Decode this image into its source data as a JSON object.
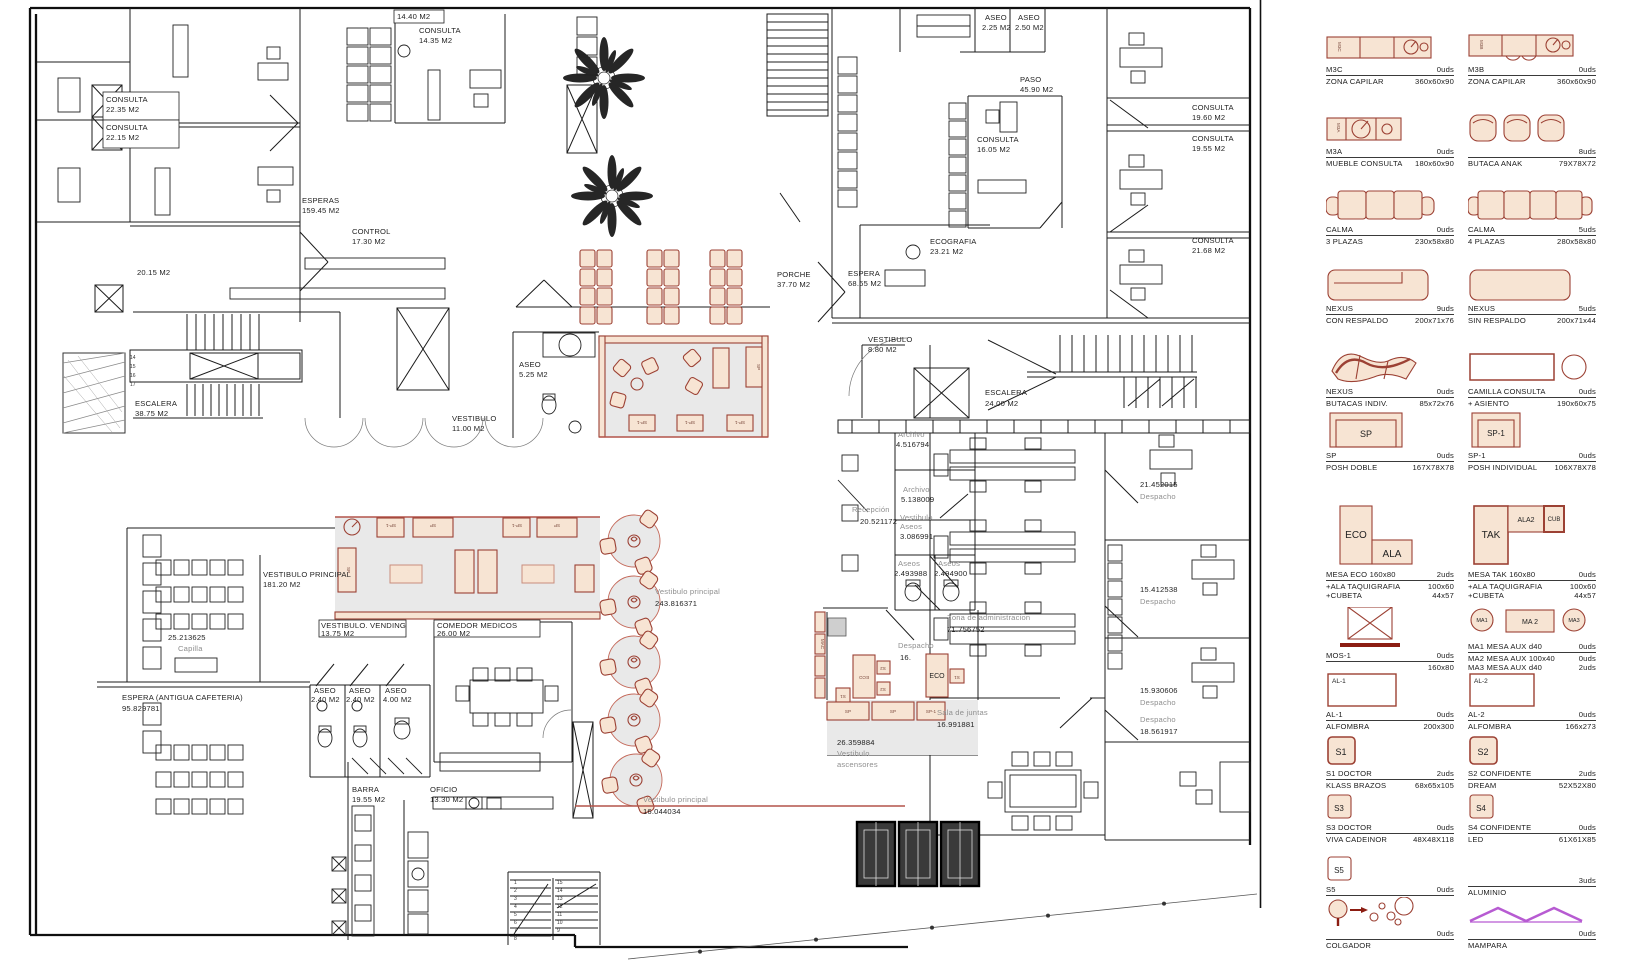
{
  "colors": {
    "furniture_fill": "#f7e4d3",
    "furniture_stroke": "#9c4134",
    "accent_red": "#b3544a",
    "mampara_purple": "#b75bd2",
    "gray_zone": "#e9e9e9",
    "gray_text": "#8f8f8f",
    "wall": "#1c1c1c"
  },
  "plan": {
    "labels": {
      "consulta_a": {
        "l1": "CONSULTA",
        "l2": "22.35 M2"
      },
      "consulta_b": {
        "l1": "CONSULTA",
        "l2": "22.15 M2"
      },
      "esperas": {
        "l1": "ESPERAS",
        "l2": "159.45 M2"
      },
      "control": {
        "l1": "CONTROL",
        "l2": "17.30 M2"
      },
      "m1440": {
        "l1": "14.40 M2"
      },
      "consulta1435": {
        "l1": "CONSULTA",
        "l2": "14.35 M2"
      },
      "a2015": {
        "l1": "20.15 M2"
      },
      "escalera38": {
        "l1": "ESCALERA",
        "l2": "38.75 M2"
      },
      "paso": {
        "l1": "PASO",
        "l2": "45.90 M2"
      },
      "aseo225": {
        "l1": "ASEO",
        "l2": "2.25 M2"
      },
      "aseo250": {
        "l1": "ASEO",
        "l2": "2.50 M2"
      },
      "consulta1605": {
        "l1": "CONSULTA",
        "l2": "16.05 M2"
      },
      "ecografia": {
        "l1": "ECOGRAFIA",
        "l2": "23.21 M2"
      },
      "consulta1960": {
        "l1": "CONSULTA",
        "l2": "19.60 M2"
      },
      "consulta1955": {
        "l1": "CONSULTA",
        "l2": "19.55 M2"
      },
      "consulta2168": {
        "l1": "CONSULTA",
        "l2": "21.68 M2"
      },
      "porche": {
        "l1": "PORCHE",
        "l2": "37.70 M2"
      },
      "espera68": {
        "l1": "ESPERA",
        "l2": "68.65 M2"
      },
      "aseo525": {
        "l1": "ASEO",
        "l2": "5.25 M2"
      },
      "vest11": {
        "l1": "VESTIBULO",
        "l2": "11.00 M2"
      },
      "vest880": {
        "l1": "VESTIBULO",
        "l2": "8.80 M2"
      },
      "escalera24": {
        "l1": "ESCALERA",
        "l2": "24.00 M2"
      },
      "archivo1": {
        "l1": "Archivo",
        "l2": "4.516794"
      },
      "archivo2": {
        "l1": "Archivo",
        "l2": "5.138009"
      },
      "recepcion": {
        "l1": "Recepción",
        "l2": "20.521172"
      },
      "vestaseos": {
        "l1": "Vestibulo",
        "l2": "Aseos",
        "l3": "3.086991"
      },
      "aseos1": {
        "l1": "Aseos",
        "l2": "2.493988"
      },
      "aseos2": {
        "l1": "Aseos",
        "l2": "2.494900"
      },
      "despacho21": {
        "l1": "21.452015",
        "l2": "Despacho"
      },
      "zona": {
        "l1": "Zona de administracion",
        "l2": "71.756752"
      },
      "despacho15a": {
        "l1": "15.412538",
        "l2": "Despacho"
      },
      "despacho15b": {
        "l1": "15.930606",
        "l2": "Despacho"
      },
      "despacho18": {
        "l1": "Despacho",
        "l2": "18.561917"
      },
      "salajuntas": {
        "l1": "Sala de juntas",
        "l2": "16.991881"
      },
      "vestasc": {
        "l1": "26.359884",
        "l2": "Vestibulo",
        "l3": "ascensores"
      },
      "vestprincipal": {
        "l1": "Vestibulo principal",
        "l2": "243.816371"
      },
      "vestprin2": {
        "l1": "Vestibulo principal",
        "l2": "16.044034"
      },
      "vestppal": {
        "l1": "VESTIBULO PRINCIPAL",
        "l2": "181.20 M2"
      },
      "vending": {
        "l1": "VESTIBULO. VENDING",
        "l2": "13.75 M2"
      },
      "comedor": {
        "l1": "COMEDOR MEDICOS",
        "l2": "26.00 M2"
      },
      "aseo240a": {
        "l1": "ASEO",
        "l2": "2.40 M2"
      },
      "aseo240b": {
        "l1": "ASEO",
        "l2": "2.40 M2"
      },
      "aseo400": {
        "l1": "ASEO",
        "l2": "4.00 M2"
      },
      "capilla": {
        "l1": "25.213625",
        "l2": "Capilla"
      },
      "esperaant": {
        "l1": "ESPERA (ANTIGUA CAFETERIA)",
        "l2": "95.829781"
      },
      "barra": {
        "l1": "BARRA",
        "l2": "19.55 M2"
      },
      "oficio": {
        "l1": "OFICIO",
        "l2": "13.30 M2"
      },
      "despacho16": {
        "l1": "Despacho",
        "l2": "16."
      }
    },
    "stairs": {
      "left": [
        "14",
        "15",
        "16",
        "17"
      ],
      "b1": [
        "1",
        "2",
        "3",
        "4",
        "5",
        "6",
        "7",
        "8"
      ],
      "b2": [
        "15",
        "14",
        "13",
        "12",
        "11",
        "10",
        "9"
      ]
    },
    "tags": {
      "sp": "SP",
      "sp1": "SP-1",
      "eco": "ECO",
      "s1": "S1",
      "s2": "S2",
      "mac": "MAC"
    }
  },
  "legend": {
    "items": [
      {
        "t1": "M3C",
        "u1": "0uds",
        "t2": "ZONA CAPILAR",
        "u2": "360x60x90",
        "tag": "M3C"
      },
      {
        "t1": "M3B",
        "u1": "0uds",
        "t2": "ZONA CAPILAR",
        "u2": "360x60x90",
        "tag": "M3B"
      },
      {
        "t1": "M3A",
        "u1": "0uds",
        "t2": "MUEBLE CONSULTA",
        "u2": "180x60x90",
        "tag": "M3A"
      },
      {
        "t1": "",
        "u1": "8uds",
        "t2": "BUTACA ANAK",
        "u2": "79X78X72"
      },
      {
        "t1": "CALMA",
        "u1": "0uds",
        "t2": "3 PLAZAS",
        "u2": "230x58x80"
      },
      {
        "t1": "CALMA",
        "u1": "5uds",
        "t2": "4 PLAZAS",
        "u2": "280x58x80"
      },
      {
        "t1": "NEXUS",
        "u1": "9uds",
        "t2": "CON RESPALDO",
        "u2": "200x71x76"
      },
      {
        "t1": "NEXUS",
        "u1": "5uds",
        "t2": "SIN RESPALDO",
        "u2": "200x71x44"
      },
      {
        "t1": "NEXUS",
        "u1": "0uds",
        "t2": "BUTACAS INDIV.",
        "u2": "85x72x76"
      },
      {
        "t1": "CAMILLA CONSULTA",
        "u1": "0uds",
        "t2": "+ ASIENTO",
        "u2": "190x60x75"
      },
      {
        "t1": "SP",
        "u1": "0uds",
        "t2": "POSH DOBLE",
        "u2": "167X78X78",
        "tag": "SP"
      },
      {
        "t1": "SP-1",
        "u1": "0uds",
        "t2": "POSH INDIVIDUAL",
        "u2": "106X78X78",
        "tag": "SP-1"
      },
      {
        "t1": "MESA ECO 160x80",
        "u1": "2uds",
        "t2": "+ALA TAQUIGRAFIA",
        "u2": "100x60",
        "t3": "+CUBETA",
        "u3": "44x57",
        "tag": "ECO",
        "tag2": "ALA"
      },
      {
        "t1": "MESA TAK 160x80",
        "u1": "0uds",
        "t2": "+ALA TAQUIGRAFIA",
        "u2": "100x60",
        "t3": "+CUBETA",
        "u3": "44x57",
        "tag": "TAK",
        "tag2": "ALA2",
        "tag3": "CUB"
      },
      {
        "t1": "MOS-1",
        "u1": "0uds",
        "t2": "",
        "u2": "160x80"
      },
      {
        "t1": "MA1 MESA AUX d40",
        "u1": "0uds",
        "t2": "MA2 MESA AUX 100x40",
        "u2": "0uds",
        "t3": "MA3 MESA AUX d40",
        "u3": "2uds",
        "tag": "MA1",
        "tag2": "MA 2",
        "tag3": "MA3"
      },
      {
        "t1": "AL-1",
        "u1": "0uds",
        "t2": "ALFOMBRA",
        "u2": "200x300",
        "tag": "AL-1"
      },
      {
        "t1": "AL-2",
        "u1": "0uds",
        "t2": "ALFOMBRA",
        "u2": "166x273",
        "tag": "AL-2"
      },
      {
        "t1": "S1 DOCTOR",
        "u1": "2uds",
        "t2": "KLASS BRAZOS",
        "u2": "68x65x105",
        "tag": "S1"
      },
      {
        "t1": "S2 CONFIDENTE",
        "u1": "2uds",
        "t2": "DREAM",
        "u2": "52X52X80",
        "tag": "S2"
      },
      {
        "t1": "S3 DOCTOR",
        "u1": "0uds",
        "t2": "VIVA CADEINOR",
        "u2": "48X48X118",
        "tag": "S3"
      },
      {
        "t1": "S4 CONFIDENTE",
        "u1": "0uds",
        "t2": "LED",
        "u2": "61X61X85",
        "tag": "S4"
      },
      {
        "t1": "S5",
        "u1": "0uds",
        "t2": "",
        "u2": "",
        "tag": "S5"
      },
      {
        "t1": "",
        "u1": "3uds",
        "t2": "ALUMINIO",
        "u2": ""
      },
      {
        "t1": "",
        "u1": "0uds",
        "t2": "COLGADOR",
        "u2": ""
      },
      {
        "t1": "",
        "u1": "0uds",
        "t2": "MAMPARA",
        "u2": ""
      }
    ]
  }
}
